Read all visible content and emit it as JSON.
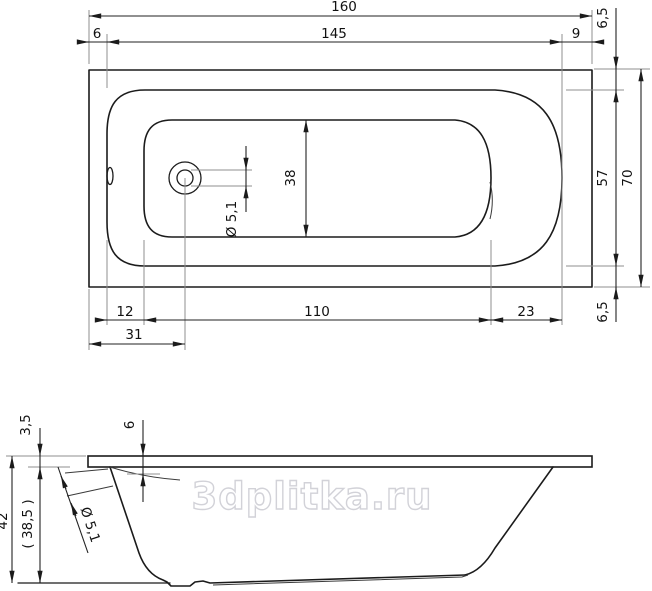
{
  "watermark": "3dplitka.ru",
  "colors": {
    "outline": "#1b1b1b",
    "dimension_line": "#222222",
    "extension_line": "#8f8f8f",
    "watermark": "#d2d2d8",
    "background": "#ffffff"
  },
  "top_view": {
    "overall_length": "160",
    "left_rim_offset": "6",
    "inner_length": "145",
    "right_rim_offset": "9",
    "top_rim_offset": "6,5",
    "inner_width": "57",
    "overall_width": "70",
    "bottom_rim_offset": "6,5",
    "basin_width": "38",
    "drain_diameter": "Ø 5,1",
    "drain_offset_from_rim": "12",
    "basin_bottom_length": "110",
    "basin_right_offset": "23",
    "drain_center_offset": "31"
  },
  "side_view": {
    "rim_thickness": "3,5",
    "rim_drop": "6",
    "overall_height": "42",
    "body_height": "( 38,5 )",
    "drain_hole_diameter": "Ø 5,1"
  }
}
